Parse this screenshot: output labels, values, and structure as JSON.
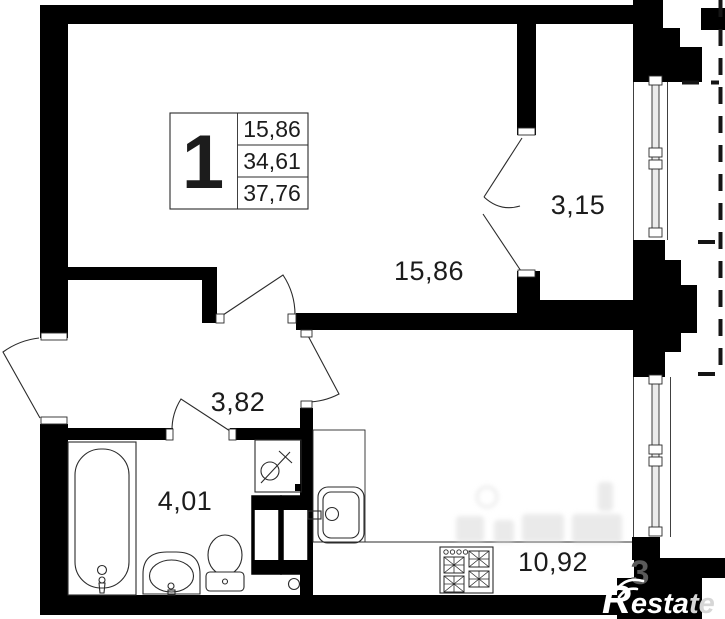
{
  "plan": {
    "unit_label": {
      "number": "1",
      "values": [
        "15,86",
        "34,61",
        "37,76"
      ]
    },
    "rooms": [
      {
        "name": "living-room",
        "area": "15,86"
      },
      {
        "name": "balcony",
        "area": "3,15"
      },
      {
        "name": "hallway",
        "area": "3,82"
      },
      {
        "name": "bathroom",
        "area": "4,01"
      },
      {
        "name": "kitchen",
        "area": "10,92"
      }
    ],
    "watermark": {
      "pier_digit": "3"
    },
    "logo": {
      "r": "R",
      "esta": "esta",
      "te": "te"
    },
    "colors": {
      "wall": "#000000",
      "background": "#ffffff",
      "line": "#2b2b2b",
      "logo_white": "#ffffff",
      "logo_gray": "#d6d6d6"
    }
  }
}
